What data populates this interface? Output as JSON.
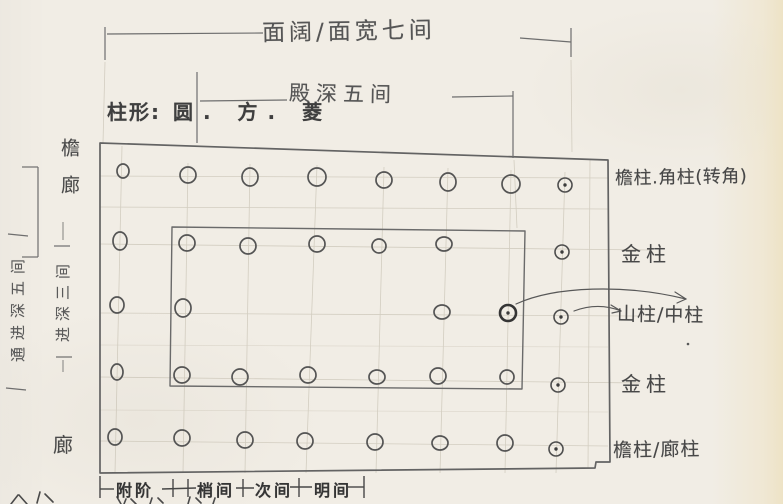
{
  "paper": {
    "bg": "#f1ede5",
    "edge_tint": "#eee3c6",
    "pencil": "#565656",
    "faint_grid": "#b5ae9d",
    "ink_dark": "#353535"
  },
  "dimensions": {
    "facade_width": "面阔/面宽七间",
    "hall_depth": "殿深五间",
    "total_depth_vertical": "通进深五间",
    "inner_depth_vertical": "进深三间"
  },
  "column_shapes": {
    "label": "柱形:",
    "value": "圆. 方. 菱"
  },
  "left_labels": {
    "eave_corridor": "檐廊",
    "corridor": "廊"
  },
  "right_labels": {
    "r1": "檐柱.角柱(转角)",
    "r2": "金柱",
    "r3": "山柱/中柱",
    "r4": "金柱",
    "r5": "檐柱/廊柱"
  },
  "bottom_bays": {
    "b1": "附阶",
    "b2": "梢间",
    "b3": "次间",
    "b4": "明间"
  },
  "diagram": {
    "description": "column-grid floor plan, 5 rows of column circles; dotted circles on right gable line, bold circle = center column on inner wall",
    "columns": [
      {
        "x": 123,
        "y": 171,
        "rx": 6,
        "ry": 7,
        "t": "p"
      },
      {
        "x": 188,
        "y": 175,
        "rx": 8,
        "ry": 8,
        "t": "p"
      },
      {
        "x": 250,
        "y": 177,
        "rx": 8,
        "ry": 9,
        "t": "p"
      },
      {
        "x": 317,
        "y": 177,
        "rx": 9,
        "ry": 9,
        "t": "p"
      },
      {
        "x": 384,
        "y": 180,
        "rx": 8,
        "ry": 8,
        "t": "p"
      },
      {
        "x": 448,
        "y": 182,
        "rx": 8,
        "ry": 9,
        "t": "p"
      },
      {
        "x": 511,
        "y": 184,
        "rx": 9,
        "ry": 9,
        "t": "p"
      },
      {
        "x": 565,
        "y": 185,
        "rx": 7,
        "ry": 7,
        "t": "d"
      },
      {
        "x": 120,
        "y": 241,
        "rx": 7,
        "ry": 9,
        "t": "p"
      },
      {
        "x": 187,
        "y": 243,
        "rx": 8,
        "ry": 8,
        "t": "p"
      },
      {
        "x": 248,
        "y": 246,
        "rx": 8,
        "ry": 8,
        "t": "p"
      },
      {
        "x": 317,
        "y": 244,
        "rx": 8,
        "ry": 8,
        "t": "p"
      },
      {
        "x": 379,
        "y": 246,
        "rx": 7,
        "ry": 7,
        "t": "p"
      },
      {
        "x": 444,
        "y": 244,
        "rx": 8,
        "ry": 7,
        "t": "p"
      },
      {
        "x": 562,
        "y": 252,
        "rx": 7,
        "ry": 7,
        "t": "d"
      },
      {
        "x": 117,
        "y": 305,
        "rx": 7,
        "ry": 8,
        "t": "p"
      },
      {
        "x": 183,
        "y": 308,
        "rx": 8,
        "ry": 9,
        "t": "p"
      },
      {
        "x": 442,
        "y": 312,
        "rx": 8,
        "ry": 7,
        "t": "p"
      },
      {
        "x": 508,
        "y": 313,
        "rx": 8,
        "ry": 8,
        "t": "b"
      },
      {
        "x": 561,
        "y": 317,
        "rx": 7,
        "ry": 7,
        "t": "d"
      },
      {
        "x": 117,
        "y": 372,
        "rx": 6,
        "ry": 8,
        "t": "p"
      },
      {
        "x": 182,
        "y": 375,
        "rx": 8,
        "ry": 8,
        "t": "p"
      },
      {
        "x": 240,
        "y": 377,
        "rx": 8,
        "ry": 8,
        "t": "p"
      },
      {
        "x": 308,
        "y": 375,
        "rx": 8,
        "ry": 8,
        "t": "p"
      },
      {
        "x": 377,
        "y": 377,
        "rx": 8,
        "ry": 7,
        "t": "p"
      },
      {
        "x": 438,
        "y": 376,
        "rx": 8,
        "ry": 8,
        "t": "p"
      },
      {
        "x": 507,
        "y": 377,
        "rx": 7,
        "ry": 7,
        "t": "p"
      },
      {
        "x": 558,
        "y": 385,
        "rx": 7,
        "ry": 7,
        "t": "d"
      },
      {
        "x": 115,
        "y": 437,
        "rx": 7,
        "ry": 8,
        "t": "p"
      },
      {
        "x": 182,
        "y": 438,
        "rx": 8,
        "ry": 8,
        "t": "p"
      },
      {
        "x": 245,
        "y": 440,
        "rx": 8,
        "ry": 8,
        "t": "p"
      },
      {
        "x": 305,
        "y": 441,
        "rx": 8,
        "ry": 8,
        "t": "p"
      },
      {
        "x": 375,
        "y": 442,
        "rx": 8,
        "ry": 8,
        "t": "p"
      },
      {
        "x": 440,
        "y": 443,
        "rx": 8,
        "ry": 7,
        "t": "p"
      },
      {
        "x": 505,
        "y": 443,
        "rx": 8,
        "ry": 8,
        "t": "p"
      },
      {
        "x": 556,
        "y": 449,
        "rx": 7,
        "ry": 7,
        "t": "d"
      }
    ]
  }
}
